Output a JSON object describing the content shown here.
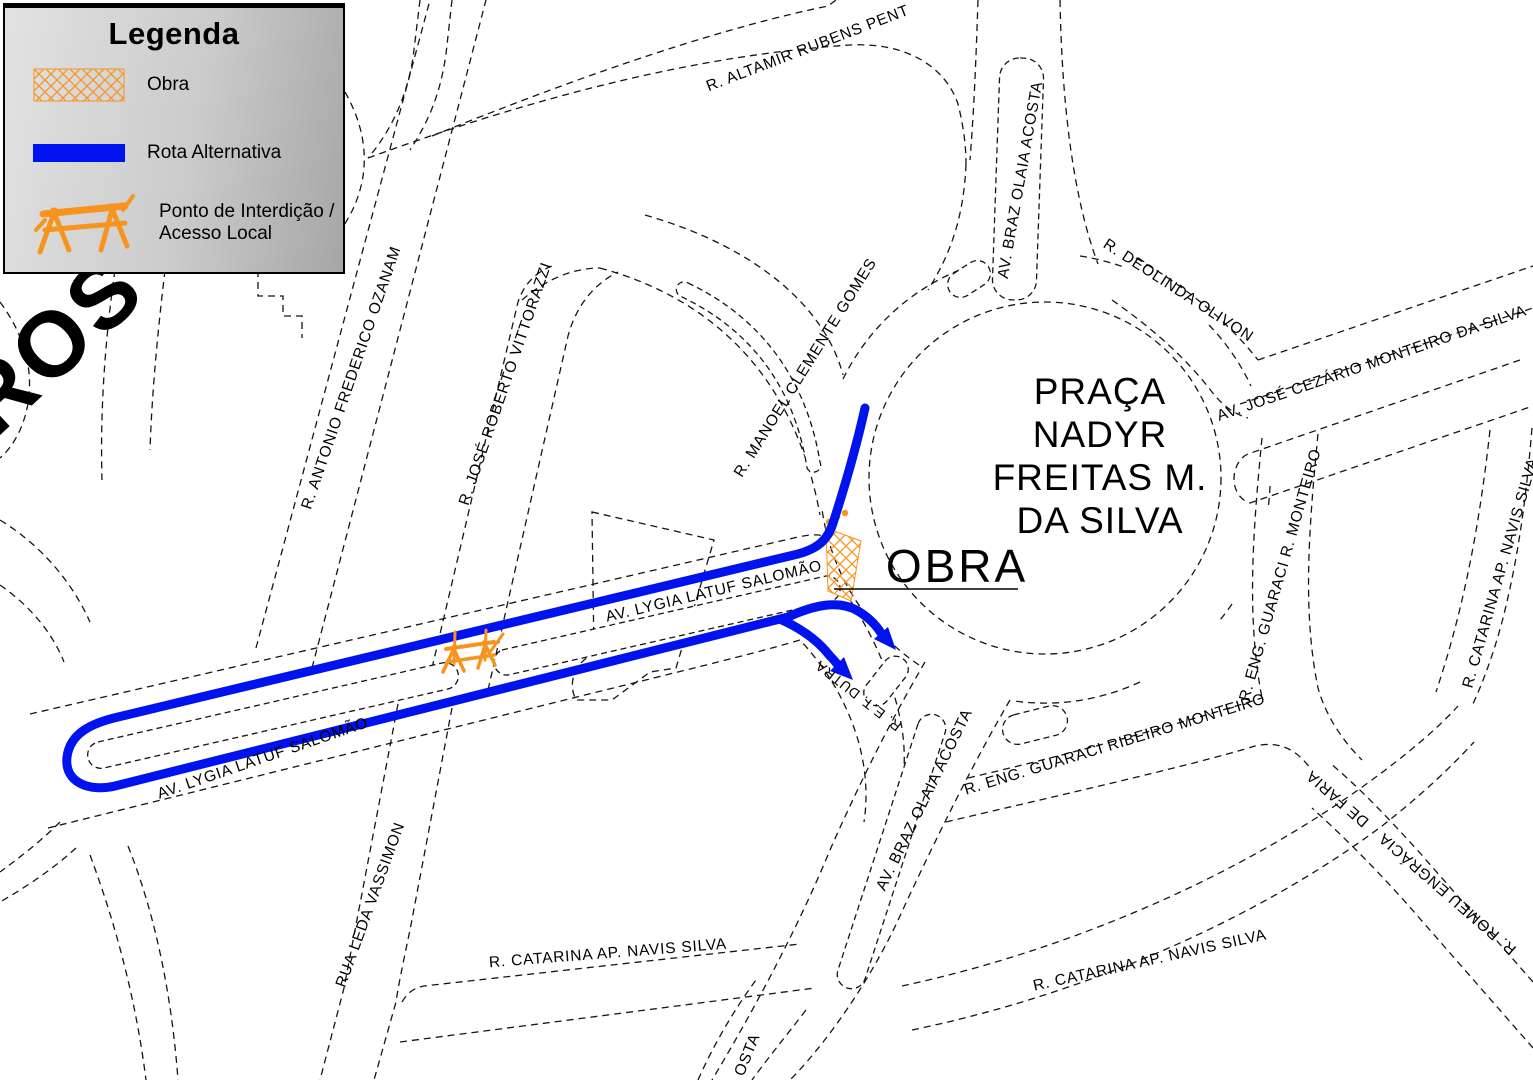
{
  "legend": {
    "title": "Legenda",
    "obra_label": "Obra",
    "rota_label": "Rota Alternativa",
    "ponto_label_line1": "Ponto de Interdição /",
    "ponto_label_line2": "Acesso Local"
  },
  "map": {
    "plaza": {
      "line1": "PRAÇA",
      "line2": "NADYR",
      "line3": "FREITAS M.",
      "line4": "DA SILVA"
    },
    "obra_callout": "OBRA",
    "partial_ros": "ROS",
    "streets": {
      "altamir": "R. ALTAMIR RUBENS PENT",
      "braz_olaia": "AV. BRAZ OLAIA ACOSTA",
      "deolinda": "R. DEOLINDA OLIVON",
      "jose_cezario": "AV. JOSÉ CEZÁRIO MONTEIRO DA SILVA",
      "manoel_clemente": "R. MANOEL CLEMENTE GOMES",
      "antonio_ozanam": "R. ANTONIO FREDERICO OZANAM",
      "jose_vittorazzi": "R. JOSÉ ROBERTO VITTORAZZI",
      "lygia": "AV. LYGIA LATUF SALOMÃO",
      "dutra": "R. E.T. DUTRA",
      "guaraci_ribeiro": "R. ENG. GUARACI RIBEIRO MONTEIRO",
      "guaraci_r": "R. ENG. GUARACI R. MONTEIRO",
      "catarina": "R. CATARINA  AP. NAVIS SILVA",
      "leda_vassimon": "RUA LEDA VASSIMON",
      "romeu_engracia": "R. ROMEU ENGRÁCIA",
      "de_faria": "DE FARIA",
      "acosta_partial": "OSTA"
    }
  },
  "colors": {
    "route_blue": "#0013ee",
    "work_orange": "#f7941e"
  }
}
